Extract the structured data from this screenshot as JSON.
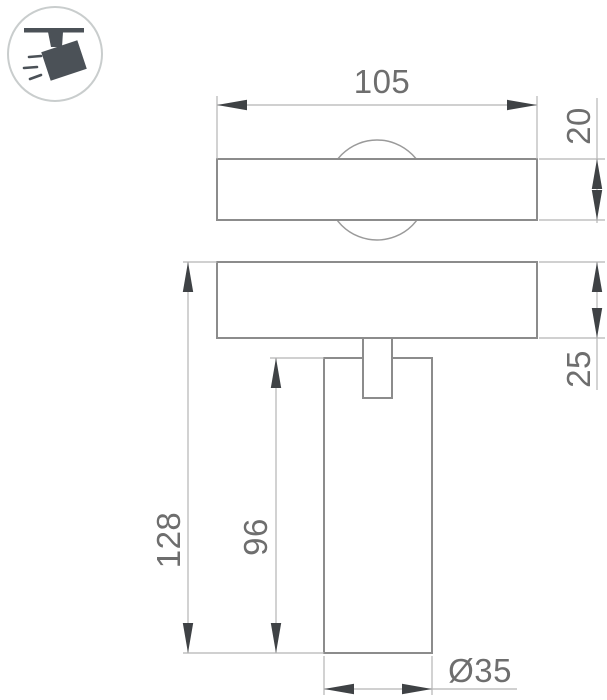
{
  "icon": {
    "name": "track-spotlight-icon",
    "description": "ceiling track with tilted spotlight head and light rays"
  },
  "views": {
    "top_view": "track bar with lamp body circle seen from above",
    "front_view": "track bar with stem and cylindrical lamp body"
  },
  "dimensions": {
    "track_width": "105",
    "track_height": "20",
    "track_depth": "25",
    "overall_height": "128",
    "body_height": "96",
    "body_diameter": "Ø35"
  },
  "colors": {
    "outline": "#8c8c8c",
    "thin_outline": "#9a9a9a",
    "dim_line": "#b5b5b5",
    "arrow": "#3f4245",
    "text": "#6e6e6e",
    "icon": "#4b5157",
    "icon_circle": "#c9cdcd",
    "background": "#ffffff"
  }
}
